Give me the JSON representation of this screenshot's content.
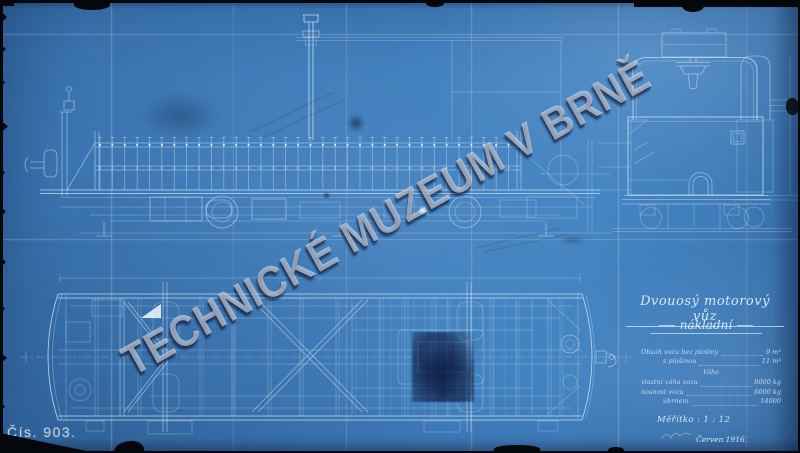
{
  "watermark": "TECHNICKÉ MUZEUM V BRNĚ",
  "corner_number": "Čís. 903.",
  "title_block": {
    "title": "Dvouosý motorový vůz",
    "subtitle": "nákladní",
    "capacity_rows": [
      {
        "label": "Obsah vozu bez plošiny",
        "value": "9 m³"
      },
      {
        "label": "s plošinou",
        "value": "11 m³"
      }
    ],
    "weight_heading": "Váha",
    "weight_rows": [
      {
        "label": "vlastní váha vozu",
        "value": "8000 kg"
      },
      {
        "label": "nosnost vozu",
        "value": "6000 kg"
      },
      {
        "label": "úhrnem",
        "value": "14000"
      }
    ],
    "scale_label": "Měřítko : 1 : 12",
    "date": "Červen 1916."
  },
  "colors": {
    "paper_blue": "#3e7bb8",
    "line_white": "#d9ecfb",
    "watermark_grey": "#e2e8f0",
    "scan_edge_black": "#04070c"
  }
}
